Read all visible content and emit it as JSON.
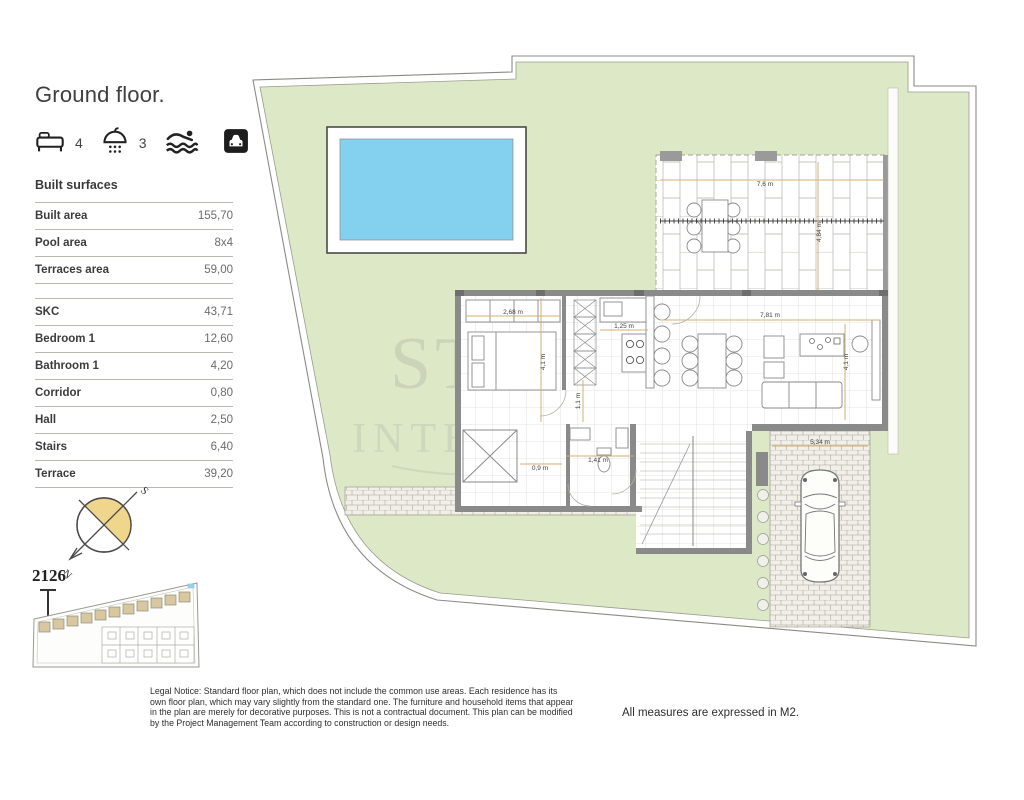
{
  "header": {
    "title": "Ground floor."
  },
  "features": [
    {
      "icon": "bed-icon",
      "count": "4"
    },
    {
      "icon": "shower-icon",
      "count": "3"
    },
    {
      "icon": "swimmer-icon",
      "count": ""
    },
    {
      "icon": "car-icon",
      "count": ""
    }
  ],
  "built_surfaces": {
    "label": "Built surfaces",
    "summary": [
      {
        "label": "Built area",
        "value": "155,70"
      },
      {
        "label": "Pool area",
        "value": "8x4"
      },
      {
        "label": "Terraces area",
        "value": "59,00"
      }
    ],
    "rooms": [
      {
        "label": "SKC",
        "value": "43,71"
      },
      {
        "label": "Bedroom 1",
        "value": "12,60"
      },
      {
        "label": "Bathroom 1",
        "value": "4,20"
      },
      {
        "label": "Corridor",
        "value": "0,80"
      },
      {
        "label": "Hall",
        "value": "2,50"
      },
      {
        "label": "Stairs",
        "value": "6,40"
      },
      {
        "label": "Terrace",
        "value": "39,20"
      }
    ]
  },
  "compass": {
    "north": "N",
    "south": "S"
  },
  "site_plan": {
    "lot_number": "2126"
  },
  "plan": {
    "dimensions": {
      "bedroom_width": "2,68 m",
      "kitchen_width": "1,25 m",
      "bedroom_depth": "4,1 m",
      "corridor_width": "1,1 m",
      "living_width": "7,81 m",
      "living_depth": "4,1 m",
      "hall_width": "1,41 m",
      "patio_width": "0,9 m",
      "terrace_width": "7,6 m",
      "terrace_depth": "4,84 m",
      "driveway_width": "5,34 m"
    }
  },
  "watermark": {
    "line1": "ST",
    "line2": "INTERNA"
  },
  "footer": {
    "legal_notice": "Legal Notice: Standard floor plan, which does not include the common use areas. Each residence has its own floor plan, which may vary slightly from the standard one. The furniture and household items that appear in the plan are merely for decorative purposes. This is not a contractual document. This plan can be modified by the Project Management Team according to construction or design needs.",
    "measures_note": "All measures are expressed in M2."
  },
  "colors": {
    "lawn": "#dde8c7",
    "pool": "#83d1ee",
    "compass_fill": "#f0d58c",
    "site_house": "#d9c7a0",
    "wall": "#8a8a8a",
    "dimension_line": "#d3af74"
  }
}
